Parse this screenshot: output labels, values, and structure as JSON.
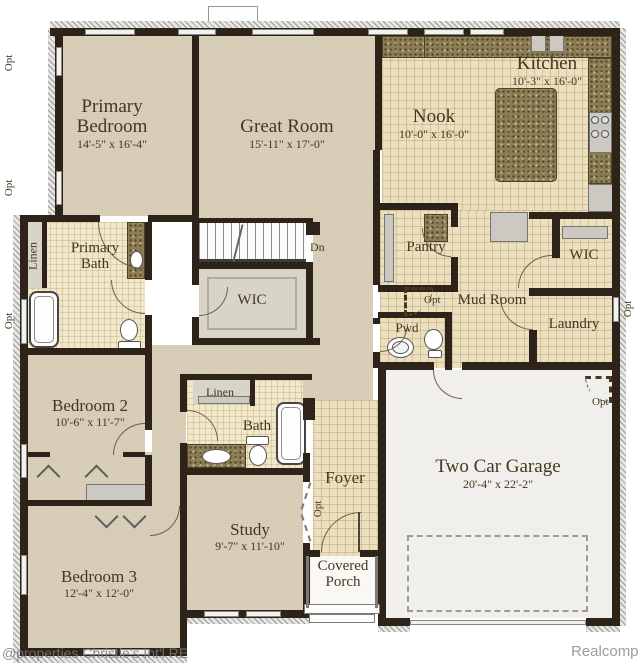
{
  "watermarks": {
    "left": "@properties Christie's Int'l RE",
    "right": "Realcomp"
  },
  "labels": {
    "dn": "Dn",
    "opt": "Opt",
    "linen": "Linen"
  },
  "rooms": {
    "primary_bedroom": {
      "name": "Primary Bedroom",
      "dims": "14'-5\" x 16'-4\""
    },
    "great_room": {
      "name": "Great Room",
      "dims": "15'-11\" x 17'-0\""
    },
    "nook": {
      "name": "Nook",
      "dims": "10'-0\" x 16'-0\""
    },
    "kitchen": {
      "name": "Kitchen",
      "dims": "10'-3\" x 16'-0\""
    },
    "primary_bath": {
      "name": "Primary Bath"
    },
    "wic_primary": {
      "name": "WIC"
    },
    "pantry": {
      "name": "Pantry"
    },
    "mud_room": {
      "name": "Mud Room"
    },
    "wic_mud": {
      "name": "WIC"
    },
    "laundry": {
      "name": "Laundry"
    },
    "pwd": {
      "name": "Pwd"
    },
    "bedroom_2": {
      "name": "Bedroom 2",
      "dims": "10'-6\" x 11'-7\""
    },
    "bath": {
      "name": "Bath"
    },
    "study": {
      "name": "Study",
      "dims": "9'-7\" x 11'-10\""
    },
    "foyer": {
      "name": "Foyer"
    },
    "covered_porch": {
      "name": "Covered Porch"
    },
    "garage": {
      "name": "Two Car Garage",
      "dims": "20'-4\" x 22'-2\""
    },
    "bedroom_3": {
      "name": "Bedroom 3",
      "dims": "12'-4\" x 12'-0\""
    }
  }
}
